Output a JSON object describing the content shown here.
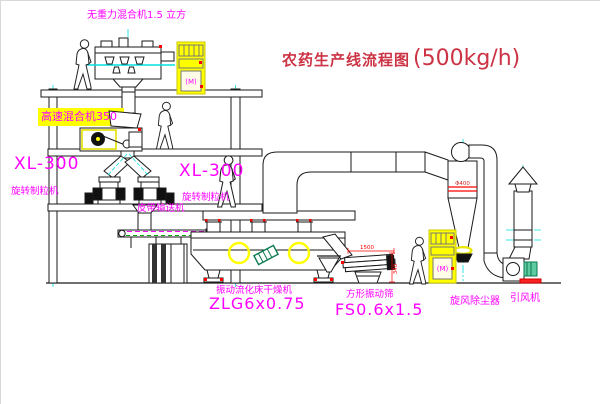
{
  "title": {
    "name_zh": "农药生产线流程图",
    "capacity": "(500kg/h)"
  },
  "equipment_labels": {
    "gravity_free_mixer": "无重力混合机1.5 立方",
    "high_speed_mixer": "高速混合机350",
    "granulator_left_model": "XL-300",
    "granulator_left_name": "旋转制粒机",
    "granulator_mid_model": "XL-300",
    "granulator_mid_name": "旋转制粒机",
    "belt_conveyor": "皮带输送机",
    "fluid_bed_dryer_name": "振动流化床干燥机",
    "fluid_bed_dryer_model": "ZLG6x0.75",
    "square_sieve_name": "方形振动筛",
    "square_sieve_model": "FS0.6x1.5",
    "cyclone": "旋风除尘器",
    "induced_draft_fan": "引风机"
  },
  "annotations": {
    "sieve_length_dim": "1500",
    "sieve_height_dim": "340",
    "cyclone_diameter": "Φ400",
    "cabinet_mark": "(M)"
  },
  "colors": {
    "label_magenta": "#ff00ff",
    "title_red": "#cc3344",
    "dimension_red": "#ff0000",
    "centerline_cyan": "#00e0e0",
    "highlight_yellow": "#ffff00",
    "motor_green": "#0a7a50",
    "line_black": "#1a1a1a"
  }
}
